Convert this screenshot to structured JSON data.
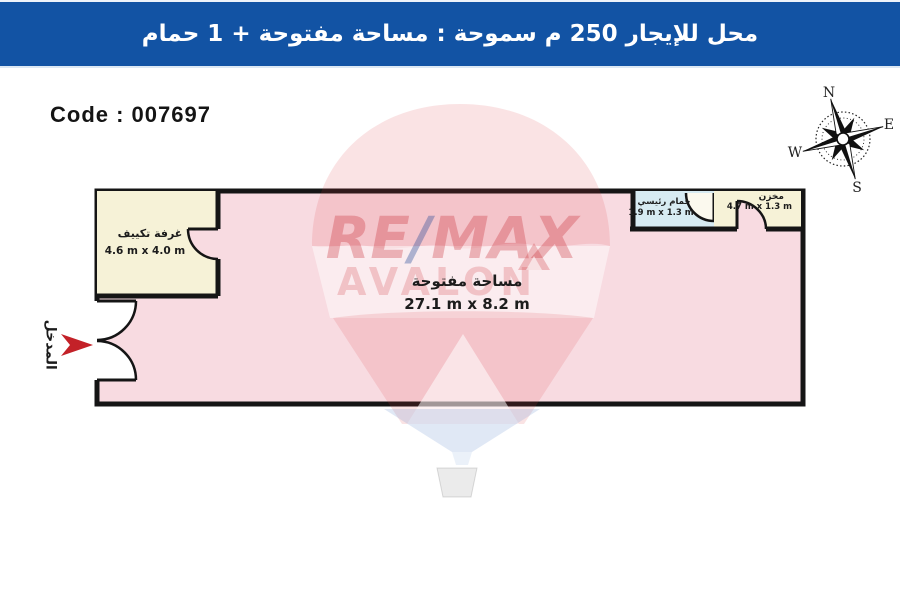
{
  "header": {
    "title": "محل للإيجار 250 م سموحة :  مساحة مفتوحة + 1 حمام",
    "bg_color": "#1253a4"
  },
  "code": {
    "label": "Code : 007697"
  },
  "compass": {
    "north": "N",
    "east": "E",
    "south": "S",
    "west": "W"
  },
  "watermark": {
    "brand_re": "RE",
    "brand_slash": "/",
    "brand_max": "MAX",
    "agency": "AVALON",
    "brand_red": "#d32f39",
    "brand_blue": "#1e4f96"
  },
  "plan": {
    "wall_color": "#151515",
    "entrance_label": "المدخل",
    "entrance_arrow_color": "#c32128",
    "rooms": {
      "open_area": {
        "name": "مساحة مفتوحة",
        "dims": "27.1 m x 8.2 m",
        "fill": "#f8dbe1"
      },
      "ac_room": {
        "name": "غرفة تكييف",
        "dims": "4.6 m x 4.0 m",
        "fill": "#f6f2d7"
      },
      "bathroom": {
        "name": "حمام رئيسي",
        "dims": "1.9 m x 1.3 m",
        "fill": "#d7ebf2"
      },
      "storage": {
        "name": "مخزن",
        "dims": "4.7 m x 1.3 m",
        "fill": "#f6f2d7"
      }
    }
  }
}
